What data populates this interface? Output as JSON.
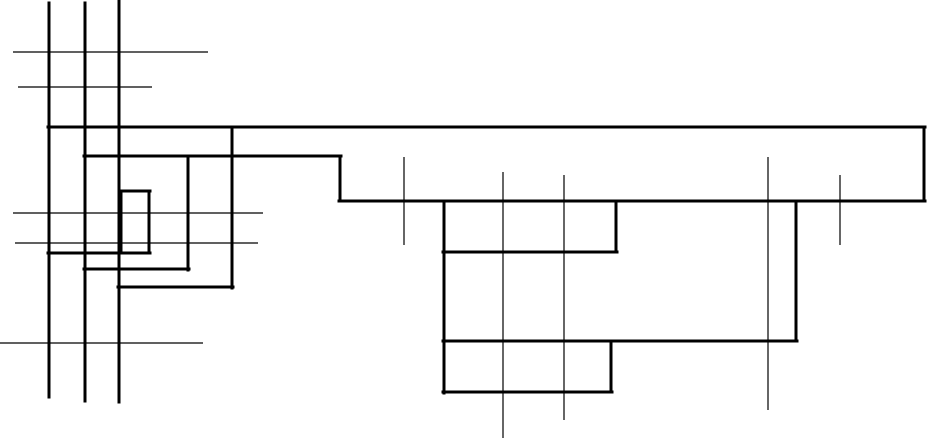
{
  "diagram": {
    "canvas": {
      "width": 927,
      "height": 438,
      "background_color": "#FFFFFF",
      "line_color": "#000000",
      "thick_width": 3,
      "thin_width": 1.2
    },
    "segments": [
      {
        "x1": 49,
        "y1": 3,
        "x2": 49,
        "y2": 397,
        "weight": "thick",
        "orient": "vertical"
      },
      {
        "x1": 85,
        "y1": 3,
        "x2": 85,
        "y2": 401,
        "weight": "thick",
        "orient": "vertical"
      },
      {
        "x1": 119,
        "y1": 0,
        "x2": 119,
        "y2": 402,
        "weight": "thick",
        "orient": "vertical"
      },
      {
        "x1": 48,
        "y1": 127,
        "x2": 925,
        "y2": 127,
        "weight": "thick",
        "orient": "horizontal"
      },
      {
        "x1": 924,
        "y1": 127,
        "x2": 924,
        "y2": 201,
        "weight": "thick",
        "orient": "vertical"
      },
      {
        "x1": 339,
        "y1": 201,
        "x2": 925,
        "y2": 201,
        "weight": "thick",
        "orient": "horizontal"
      },
      {
        "x1": 84,
        "y1": 156,
        "x2": 341,
        "y2": 156,
        "weight": "thick",
        "orient": "horizontal"
      },
      {
        "x1": 340,
        "y1": 156,
        "x2": 340,
        "y2": 201,
        "weight": "thick",
        "orient": "vertical"
      },
      {
        "x1": 232,
        "y1": 127,
        "x2": 232,
        "y2": 288,
        "weight": "thick",
        "orient": "vertical"
      },
      {
        "x1": 188,
        "y1": 156,
        "x2": 188,
        "y2": 270,
        "weight": "thick",
        "orient": "vertical"
      },
      {
        "x1": 84,
        "y1": 269,
        "x2": 189,
        "y2": 269,
        "weight": "thick",
        "orient": "horizontal"
      },
      {
        "x1": 118,
        "y1": 287,
        "x2": 233,
        "y2": 287,
        "weight": "thick",
        "orient": "horizontal"
      },
      {
        "x1": 48,
        "y1": 253,
        "x2": 150,
        "y2": 253,
        "weight": "thick",
        "orient": "horizontal"
      },
      {
        "x1": 121,
        "y1": 191,
        "x2": 121,
        "y2": 253,
        "weight": "thick",
        "orient": "vertical"
      },
      {
        "x1": 120,
        "y1": 191,
        "x2": 150,
        "y2": 191,
        "weight": "thick",
        "orient": "horizontal"
      },
      {
        "x1": 149,
        "y1": 191,
        "x2": 149,
        "y2": 253,
        "weight": "thick",
        "orient": "vertical"
      },
      {
        "x1": 444,
        "y1": 201,
        "x2": 444,
        "y2": 393,
        "weight": "thick",
        "orient": "vertical"
      },
      {
        "x1": 443,
        "y1": 252,
        "x2": 617,
        "y2": 252,
        "weight": "thick",
        "orient": "horizontal"
      },
      {
        "x1": 616,
        "y1": 201,
        "x2": 616,
        "y2": 252,
        "weight": "thick",
        "orient": "vertical"
      },
      {
        "x1": 443,
        "y1": 341,
        "x2": 797,
        "y2": 341,
        "weight": "thick",
        "orient": "horizontal"
      },
      {
        "x1": 796,
        "y1": 201,
        "x2": 796,
        "y2": 341,
        "weight": "thick",
        "orient": "vertical"
      },
      {
        "x1": 443,
        "y1": 392,
        "x2": 612,
        "y2": 392,
        "weight": "thick",
        "orient": "horizontal"
      },
      {
        "x1": 611,
        "y1": 341,
        "x2": 611,
        "y2": 392,
        "weight": "thick",
        "orient": "vertical"
      },
      {
        "x1": 13,
        "y1": 52,
        "x2": 208,
        "y2": 52,
        "weight": "thin",
        "orient": "horizontal"
      },
      {
        "x1": 18,
        "y1": 87,
        "x2": 152,
        "y2": 87,
        "weight": "thin",
        "orient": "horizontal"
      },
      {
        "x1": 13,
        "y1": 213,
        "x2": 263,
        "y2": 213,
        "weight": "thin",
        "orient": "horizontal"
      },
      {
        "x1": 15,
        "y1": 243,
        "x2": 258,
        "y2": 243,
        "weight": "thin",
        "orient": "horizontal"
      },
      {
        "x1": 0,
        "y1": 343,
        "x2": 203,
        "y2": 343,
        "weight": "thin",
        "orient": "horizontal"
      },
      {
        "x1": 404,
        "y1": 157,
        "x2": 404,
        "y2": 245,
        "weight": "thin",
        "orient": "vertical"
      },
      {
        "x1": 503,
        "y1": 172,
        "x2": 503,
        "y2": 438,
        "weight": "thin",
        "orient": "vertical"
      },
      {
        "x1": 564,
        "y1": 175,
        "x2": 564,
        "y2": 420,
        "weight": "thin",
        "orient": "vertical"
      },
      {
        "x1": 768,
        "y1": 157,
        "x2": 768,
        "y2": 410,
        "weight": "thin",
        "orient": "vertical"
      },
      {
        "x1": 840,
        "y1": 175,
        "x2": 840,
        "y2": 245,
        "weight": "thin",
        "orient": "vertical"
      }
    ]
  }
}
